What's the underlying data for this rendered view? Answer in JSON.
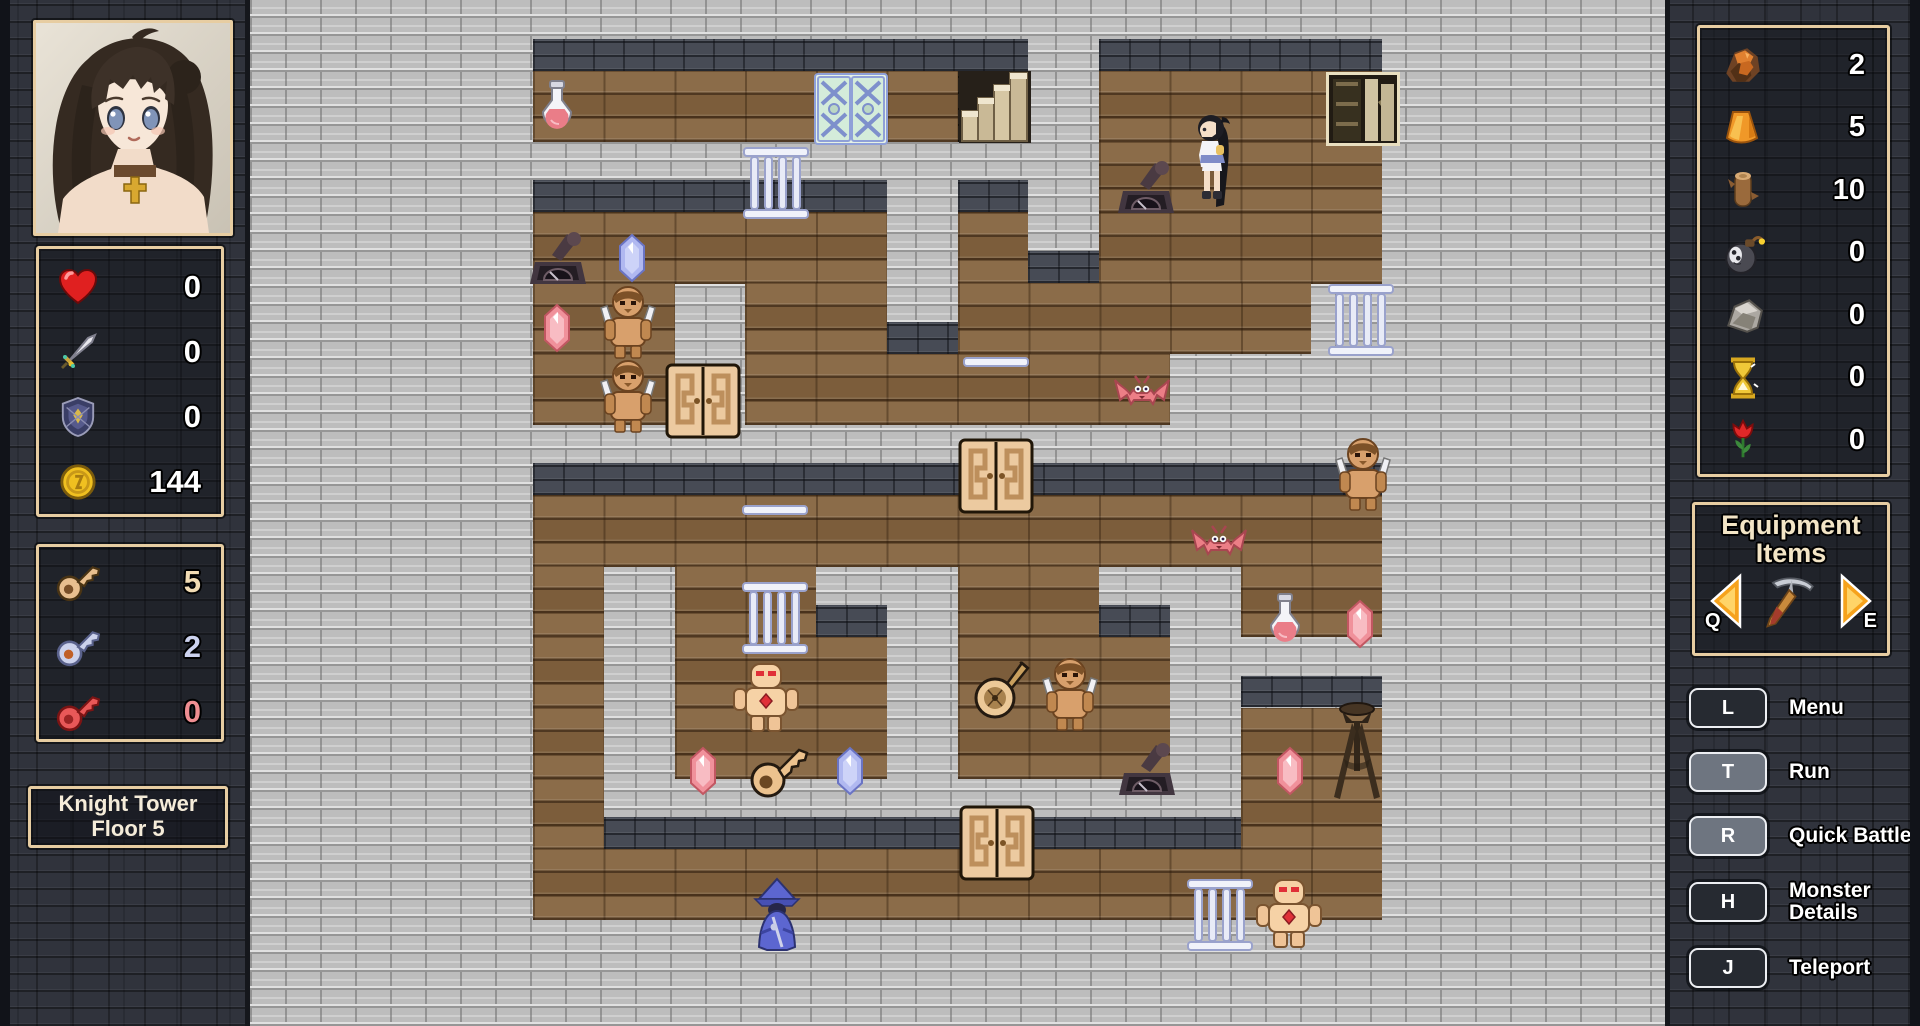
{
  "left_sidebar": {
    "portrait_alt": "character-portrait",
    "stats": [
      {
        "icon": "heart-icon",
        "value": "0"
      },
      {
        "icon": "sword-icon",
        "value": "0"
      },
      {
        "icon": "shield-icon",
        "value": "0"
      },
      {
        "icon": "coin-icon",
        "value": "144"
      }
    ],
    "keys": [
      {
        "icon": "gold-key-icon",
        "value": "5",
        "value_color": "#f2dcb4"
      },
      {
        "icon": "silver-key-icon",
        "value": "2",
        "value_color": "#ccd2ee"
      },
      {
        "icon": "red-key-icon",
        "value": "0",
        "value_color": "#ef8e92"
      }
    ],
    "location": {
      "line1": "Knight Tower",
      "line2": "Floor 5"
    }
  },
  "right_sidebar": {
    "resources": [
      {
        "icon": "ore-icon",
        "value": "2"
      },
      {
        "icon": "amber-icon",
        "value": "5"
      },
      {
        "icon": "wood-log-icon",
        "value": "10"
      },
      {
        "icon": "bomb-icon",
        "value": "0"
      },
      {
        "icon": "stone-icon",
        "value": "0"
      },
      {
        "icon": "hourglass-icon",
        "value": "0"
      },
      {
        "icon": "tulip-icon",
        "value": "0"
      }
    ],
    "equipment": {
      "title_line1": "Equipment",
      "title_line2": "Items",
      "prev_key": "Q",
      "next_key": "E",
      "current_item_icon": "pickaxe-icon"
    },
    "shortcuts": [
      {
        "key": "L",
        "label": "Menu",
        "variant": "dark",
        "two_line": false
      },
      {
        "key": "T",
        "label": "Run",
        "variant": "light",
        "two_line": false
      },
      {
        "key": "R",
        "label": "Quick Battle",
        "variant": "light",
        "two_line": false
      },
      {
        "key": "H",
        "label": "Monster Details",
        "variant": "dark",
        "two_line": true
      },
      {
        "key": "J",
        "label": "Teleport",
        "variant": "dark",
        "two_line": false
      }
    ]
  },
  "map": {
    "cols": 20,
    "rows": 15,
    "legend": {
      "#": "stone-wall",
      ".": "wood-floor",
      "*": "stairwell-dark-floor"
    },
    "grid": [
      "####################",
      "####......*#....####",
      "############....####",
      "####.....#.#....####",
      "####..#..#.....#####",
      "####..#......#######",
      "####################",
      "####............####",
      "####.#..##..##..####",
      "####.#...#...#######",
      "####.#...#...#..####",
      "####.#########..####",
      "####............####",
      "####################",
      "####################"
    ],
    "entities": [
      {
        "type": "potion",
        "x": 557,
        "y": 108
      },
      {
        "type": "ice-door",
        "x": 851,
        "y": 109
      },
      {
        "type": "stairs",
        "x": 995,
        "y": 107
      },
      {
        "type": "bookshelf",
        "x": 1363,
        "y": 109
      },
      {
        "type": "player",
        "x": 1214,
        "y": 163
      },
      {
        "type": "lever",
        "x": 1146,
        "y": 190
      },
      {
        "type": "gate",
        "x": 776,
        "y": 183
      },
      {
        "type": "lever",
        "x": 558,
        "y": 261
      },
      {
        "type": "crystal-blue",
        "x": 632,
        "y": 258
      },
      {
        "type": "crystal-red",
        "x": 557,
        "y": 328
      },
      {
        "type": "gnoll",
        "x": 628,
        "y": 322
      },
      {
        "type": "gnoll",
        "x": 628,
        "y": 396
      },
      {
        "type": "door",
        "x": 703,
        "y": 401
      },
      {
        "type": "rail",
        "x": 996,
        "y": 362
      },
      {
        "type": "bat",
        "x": 1142,
        "y": 395
      },
      {
        "type": "gate",
        "x": 1361,
        "y": 320
      },
      {
        "type": "door",
        "x": 996,
        "y": 476
      },
      {
        "type": "gnoll",
        "x": 1363,
        "y": 474
      },
      {
        "type": "bat",
        "x": 1219,
        "y": 545
      },
      {
        "type": "rail",
        "x": 775,
        "y": 510
      },
      {
        "type": "potion",
        "x": 1285,
        "y": 621
      },
      {
        "type": "crystal-red",
        "x": 1360,
        "y": 624
      },
      {
        "type": "gate",
        "x": 775,
        "y": 618
      },
      {
        "type": "golem",
        "x": 766,
        "y": 698
      },
      {
        "type": "lute",
        "x": 1000,
        "y": 688
      },
      {
        "type": "gnoll",
        "x": 1070,
        "y": 694
      },
      {
        "type": "crystal-red",
        "x": 703,
        "y": 771
      },
      {
        "type": "key-item",
        "x": 779,
        "y": 770
      },
      {
        "type": "crystal-blue",
        "x": 850,
        "y": 771
      },
      {
        "type": "lever",
        "x": 1147,
        "y": 772
      },
      {
        "type": "crystal-red",
        "x": 1290,
        "y": 771
      },
      {
        "type": "tripod",
        "x": 1357,
        "y": 752
      },
      {
        "type": "door",
        "x": 997,
        "y": 843
      },
      {
        "type": "mage",
        "x": 777,
        "y": 914
      },
      {
        "type": "gate",
        "x": 1220,
        "y": 915
      },
      {
        "type": "golem",
        "x": 1289,
        "y": 914
      }
    ]
  },
  "colors": {
    "panel_border": "#e7cda2",
    "sidebar_bg": "#30333c",
    "stone_wall": "#bdbdbd",
    "wall_face": "#474b55",
    "wood_floor": "#85643f",
    "value_text": "#ffffff",
    "arrow_orange": "#f6a21c"
  }
}
